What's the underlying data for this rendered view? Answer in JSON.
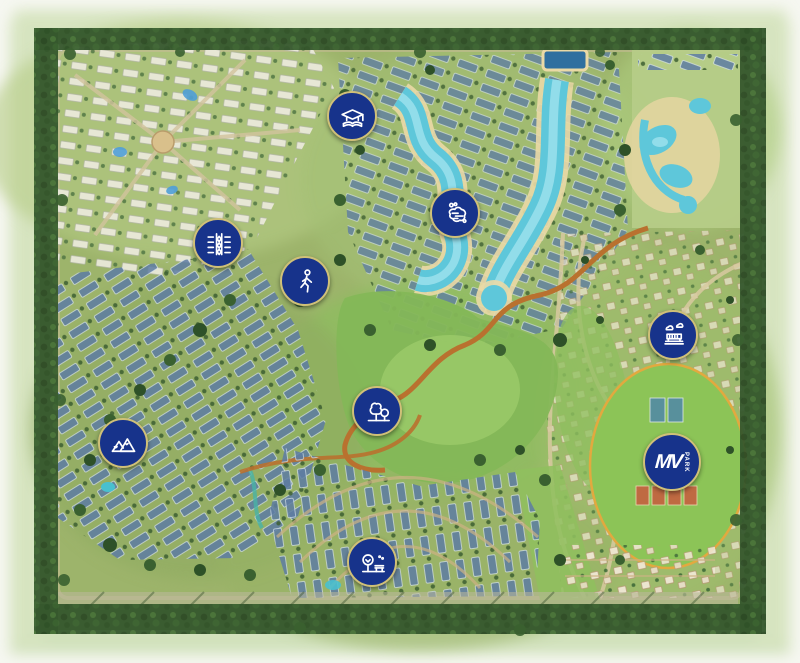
{
  "map": {
    "name": "residential-community-master-plan",
    "mv_marker": {
      "label_main": "MV",
      "label_sub": "PARK"
    },
    "markers": [
      {
        "name": "education-hub",
        "icon": "graduation-cap-icon",
        "x": 352,
        "y": 116
      },
      {
        "name": "tree-lined-boulevard",
        "icon": "boulevard-median-icon",
        "x": 218,
        "y": 243
      },
      {
        "name": "walking-trails",
        "icon": "pedestrian-icon",
        "x": 305,
        "y": 281
      },
      {
        "name": "crystal-lagoon",
        "icon": "lagoon-pool-icon",
        "x": 455,
        "y": 213
      },
      {
        "name": "hills-landscape",
        "icon": "mountains-icon",
        "x": 123,
        "y": 443
      },
      {
        "name": "central-park",
        "icon": "trees-icon",
        "x": 377,
        "y": 411
      },
      {
        "name": "pocket-park",
        "icon": "tree-bench-icon",
        "x": 372,
        "y": 562
      },
      {
        "name": "open-air-pavilion",
        "icon": "pavilion-clouds-icon",
        "x": 673,
        "y": 335
      },
      {
        "name": "mv-park",
        "icon": "mv-park-logo",
        "x": 672,
        "y": 462
      }
    ],
    "colors": {
      "marker_fill": "#17338b",
      "marker_ring": "#cfc078",
      "icon_stroke": "#ffffff",
      "lagoon_water": "#5ec7da",
      "trail_orange": "#b9712f",
      "park_outline": "#e2a93f"
    }
  }
}
